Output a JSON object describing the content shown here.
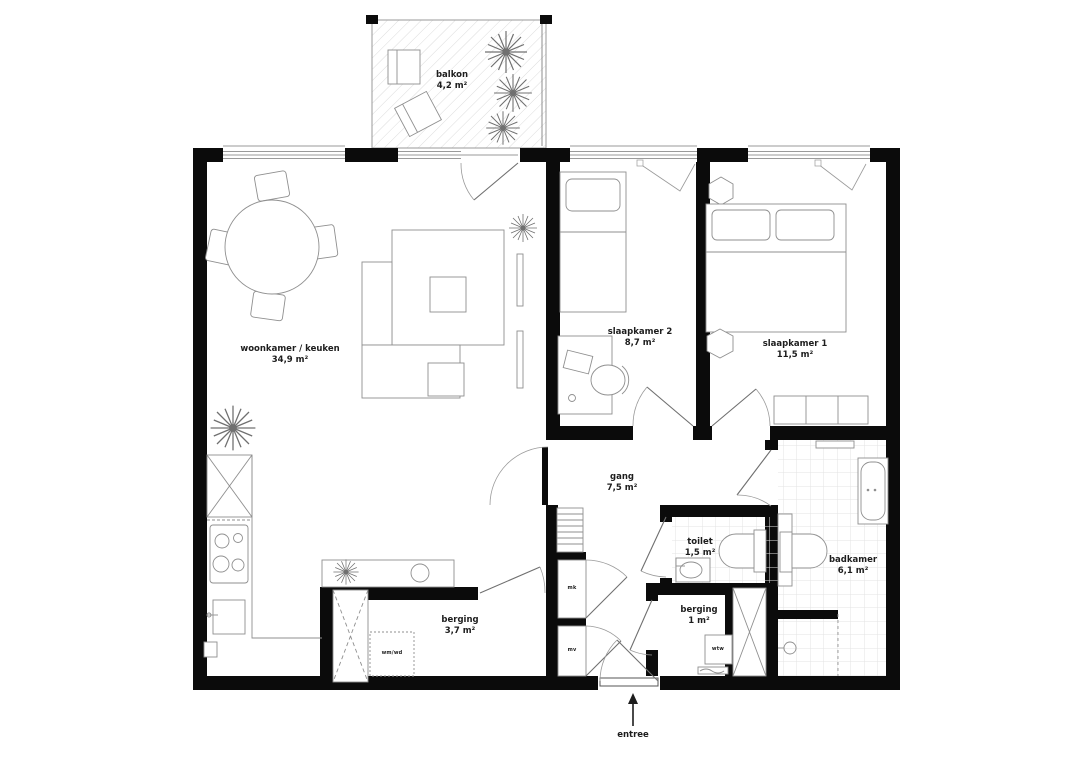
{
  "plan": {
    "rooms": [
      {
        "name": "balkon",
        "area": "4,2 m²"
      },
      {
        "name": "woonkamer / keuken",
        "area": "34,9 m²"
      },
      {
        "name": "slaapkamer 2",
        "area": "8,7 m²"
      },
      {
        "name": "slaapkamer 1",
        "area": "11,5 m²"
      },
      {
        "name": "gang",
        "area": "7,5 m²"
      },
      {
        "name": "toilet",
        "area": "1,5 m²"
      },
      {
        "name": "badkamer",
        "area": "6,1 m²"
      },
      {
        "name": "berging",
        "area": "3,7 m²"
      },
      {
        "name": "berging",
        "area": "1 m²"
      }
    ],
    "annotations": {
      "entree": "entree",
      "washer_dryer": "wm/wd",
      "meter_cupboard": "mk",
      "ventilation": "mv",
      "heat_recovery": "wtw"
    },
    "colors": {
      "wall": "#0b0b0b",
      "line": "#8f8f8f",
      "tile": "#e3e3e3"
    }
  }
}
